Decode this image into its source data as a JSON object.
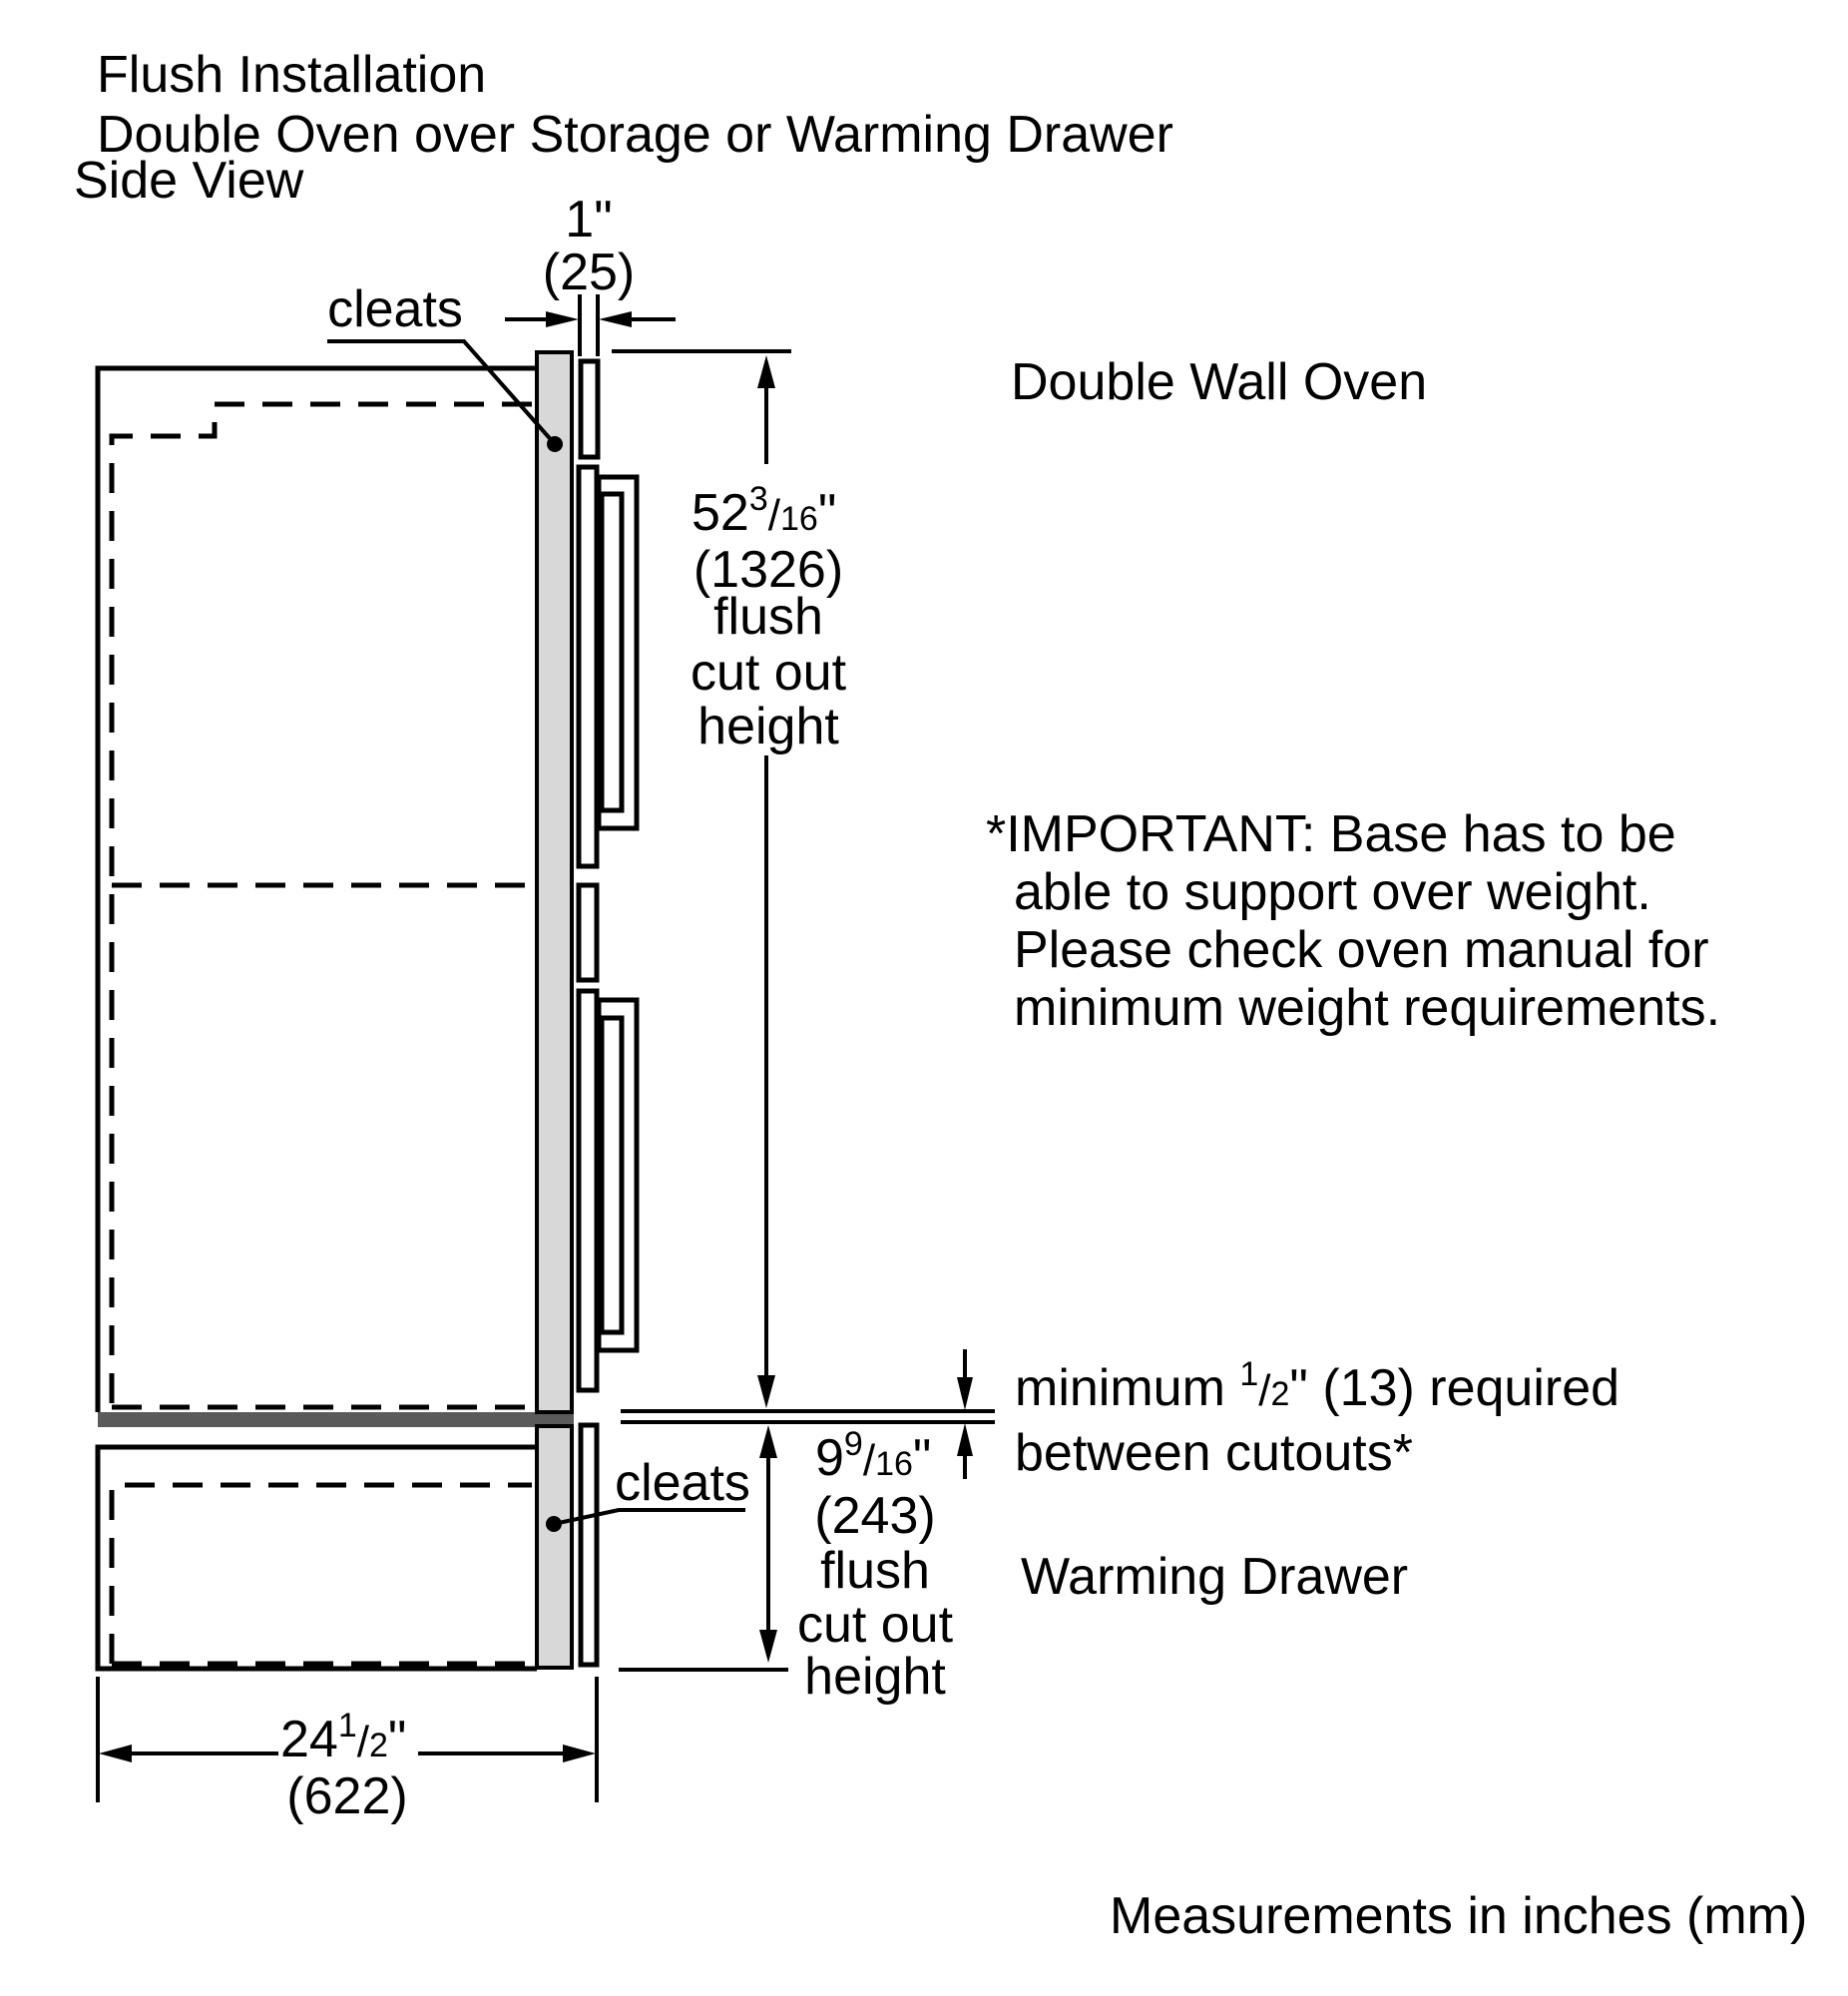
{
  "title": {
    "line1": "Flush Installation",
    "line2": "Double Oven over Storage or Warming Drawer"
  },
  "view_label": "Side View",
  "labels": {
    "cleats_top": "cleats",
    "cleats_bottom": "cleats",
    "double_wall_oven": "Double Wall Oven",
    "warming_drawer": "Warming Drawer"
  },
  "important_note": {
    "line1": "*IMPORTANT: Base has to be",
    "line2": "able to support over weight.",
    "line3": "Please check oven manual for",
    "line4": "minimum weight requirements."
  },
  "min_gap_note": {
    "prefix": "minimum ",
    "frac_num": "1",
    "frac_den": "2",
    "suffix": "\" (13) required",
    "line2": "between cutouts*"
  },
  "dimensions": {
    "top_reveal": {
      "inches": "1\"",
      "mm": "(25)"
    },
    "oven_cutout": {
      "whole": "52",
      "frac_num": "3",
      "frac_den": "16",
      "unit": "\"",
      "mm": "(1326)",
      "desc1": "flush",
      "desc2": "cut out",
      "desc3": "height"
    },
    "drawer_cutout": {
      "whole": "9",
      "frac_num": "9",
      "frac_den": "16",
      "unit": "\"",
      "mm": "(243)",
      "desc1": "flush",
      "desc2": "cut out",
      "desc3": "height"
    },
    "depth": {
      "whole": "24",
      "frac_num": "1",
      "frac_den": "2",
      "unit": "\"",
      "mm": "(622)"
    }
  },
  "chars": {
    "slash": "/"
  },
  "footer": "Measurements in inches (mm)",
  "colors": {
    "cleat_fill": "#d8d8d8",
    "divider_fill": "#5a5a5a",
    "line": "#000000"
  }
}
